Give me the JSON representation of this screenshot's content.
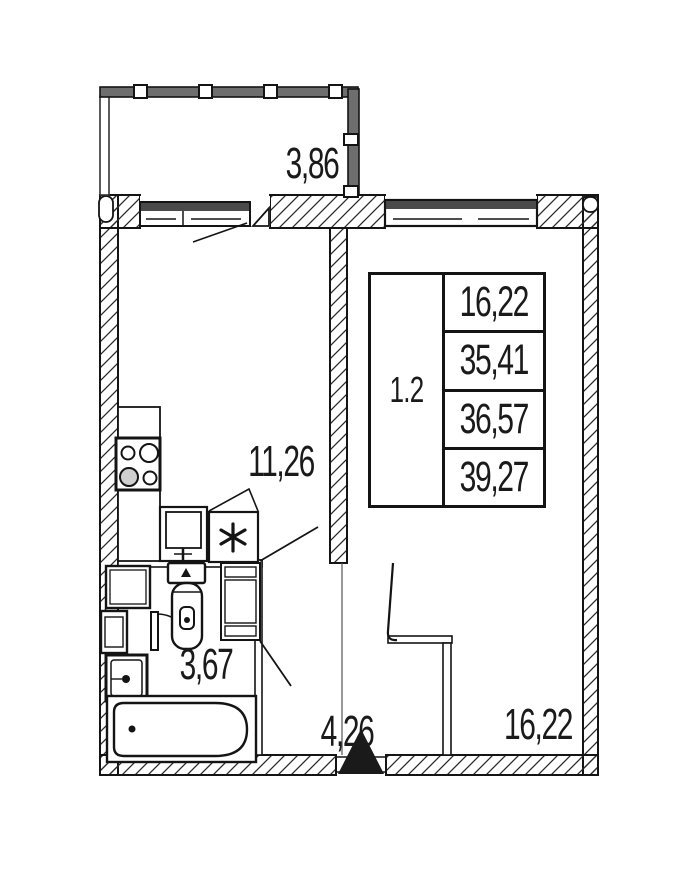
{
  "plan": {
    "balcony": {
      "area": "3,86"
    },
    "kitchen": {
      "area": "11,26"
    },
    "bathroom": {
      "area": "3,67"
    },
    "hallway": {
      "area": "4,26"
    },
    "room": {
      "area": "16,22"
    }
  },
  "info_table": {
    "unit_number": "1.2",
    "values": [
      "16,22",
      "35,41",
      "36,57",
      "39,27"
    ]
  },
  "colors": {
    "line": "#1a1a1a",
    "window_band": "#6e6e6e",
    "background": "#ffffff"
  }
}
